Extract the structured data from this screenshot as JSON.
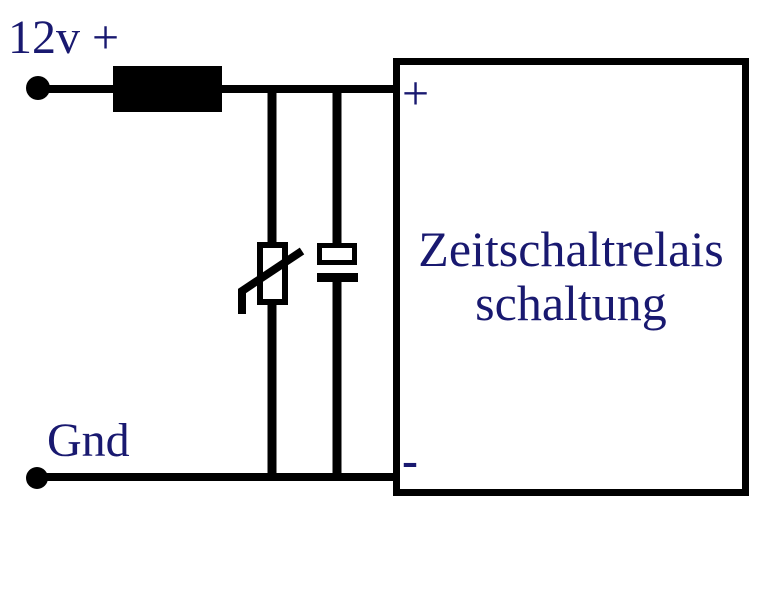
{
  "diagram": {
    "type": "circuit-schematic",
    "labels": {
      "supply": "12v +",
      "ground": "Gnd"
    },
    "relay_box": {
      "title_line1": "Zeitschaltrelais",
      "title_line2": "schaltung",
      "plus_terminal": "+",
      "minus_terminal": "-"
    },
    "components": [
      "supply-terminal-dot",
      "fuse-symbol",
      "varistor-symbol",
      "capacitor-symbol",
      "ground-terminal-dot",
      "relay-box"
    ],
    "colors": {
      "wire": "#000000",
      "component_fill": "#000000",
      "label_text": "#191970",
      "background": "#ffffff"
    }
  }
}
